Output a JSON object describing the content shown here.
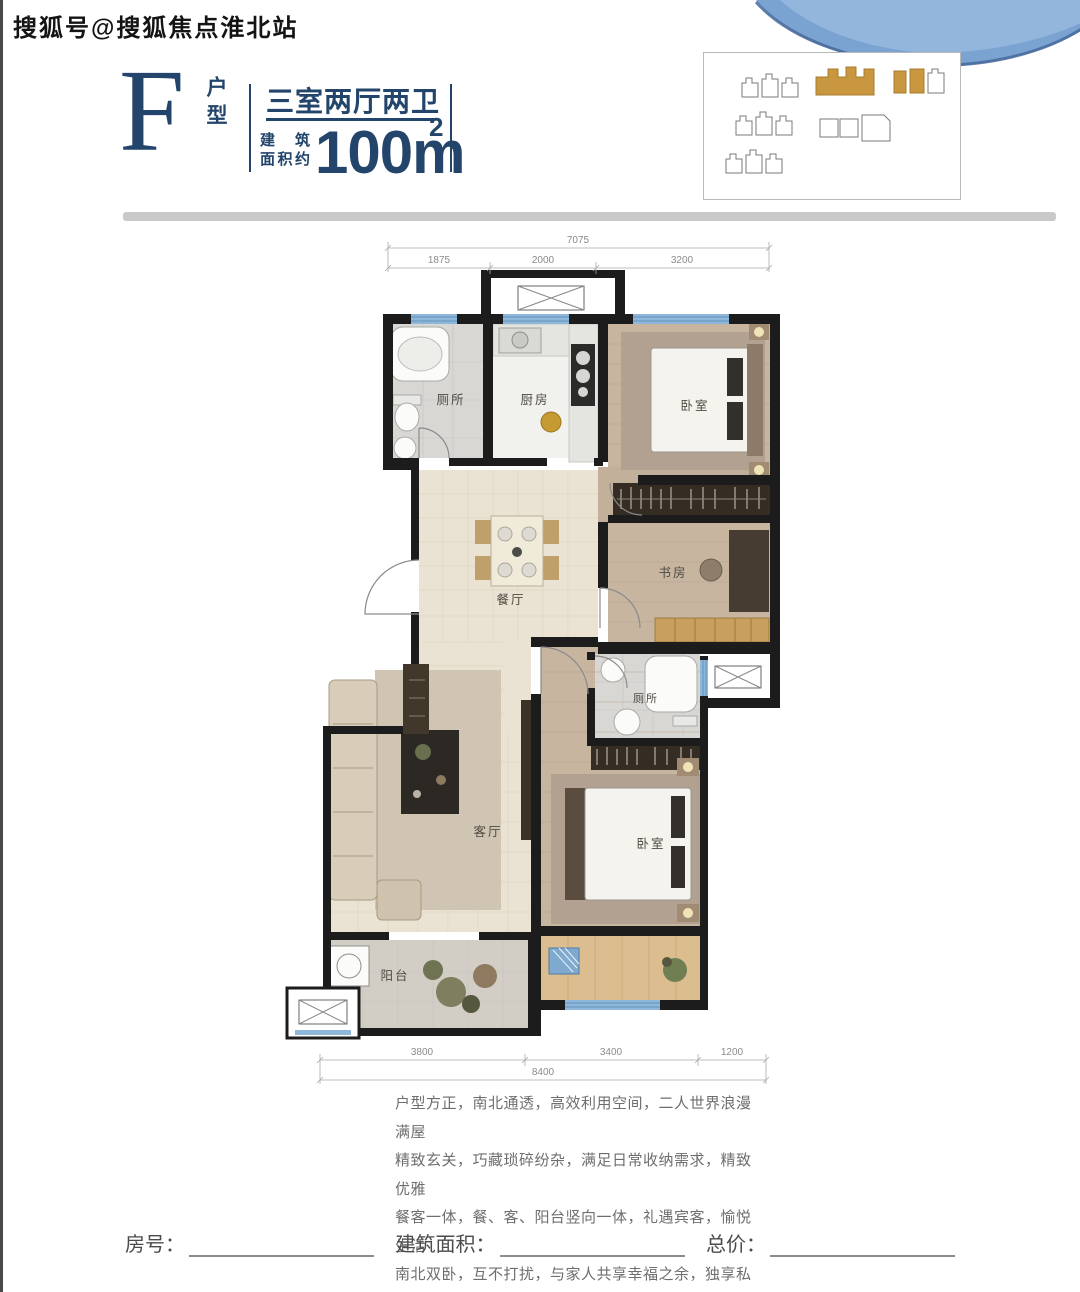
{
  "watermark": "搜狐号@搜狐焦点淮北站",
  "header": {
    "plan_letter": "F",
    "plan_type": "户型",
    "layout_title": "三室两厅两卫",
    "area_label_line1": "建 筑",
    "area_label_line2": "面积约",
    "area_value": "100m",
    "area_superscript": "2"
  },
  "floor_plan": {
    "rooms": {
      "bath1": "厕所",
      "kitchen": "厨房",
      "bedroom1": "卧室",
      "study": "书房",
      "dining": "餐厅",
      "living": "客厅",
      "bath2": "厕所",
      "bedroom2": "卧室",
      "balcony": "阳台"
    },
    "dims_top": {
      "total": "7075",
      "seg1": "1875",
      "seg2": "2000",
      "seg3": "3200"
    },
    "dims_bottom": {
      "total": "8400",
      "seg1": "3800",
      "seg2": "3400",
      "seg3": "1200"
    }
  },
  "description": {
    "line1": "户型方正，南北通透，高效利用空间，二人世界浪漫满屋",
    "line2": "精致玄关，巧藏琐碎纷杂，满足日常收纳需求，精致优雅",
    "line3": "餐客一体，餐、客、阳台竖向一体，礼遇宾客，愉悦生活",
    "line4": "南北双卧，互不打扰，与家人共享幸福之余，独享私密"
  },
  "form": {
    "room_no_label": "房号：",
    "area_label": "建筑面积：",
    "price_label": "总价："
  },
  "colors": {
    "brand_navy": "#24456b",
    "highlight_gold": "#c9973f",
    "wall_black": "#1c1c1c",
    "window_blue": "#8fb7da",
    "watercolor_blue": "#6d9cce",
    "divider_grey": "#c9c9c9"
  }
}
